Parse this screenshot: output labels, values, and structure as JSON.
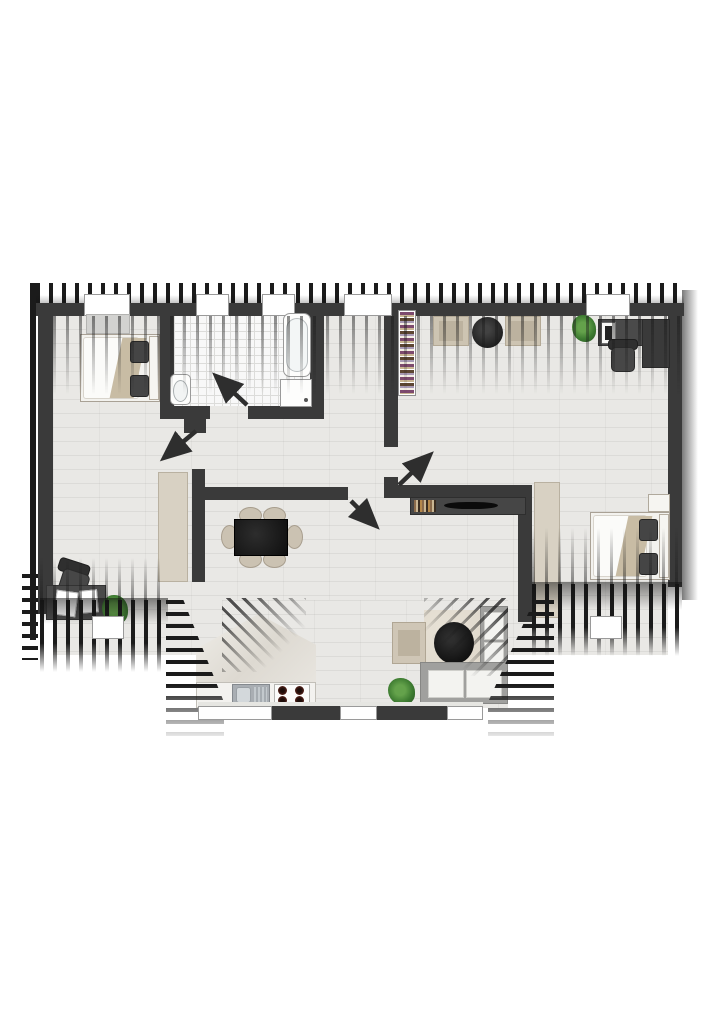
{
  "plan": {
    "canvas": {
      "w": 724,
      "h": 1024,
      "background": "#ffffff"
    },
    "palette": {
      "wall": "#3a3a3a",
      "hatch": "#1b1b1b",
      "floor": "#e9e8e5",
      "tile": "#f8f8f8",
      "tileLine": "#dcdcda",
      "beige": "#cbc2b2",
      "white": "#fbfbf9",
      "pillow": "#454545",
      "blanket": "#c8bca4",
      "green1": "#64a24b",
      "green2": "#2e5c26",
      "sofa": "#a0a09e",
      "cush": "#f3f3f0",
      "rug": "#ddd6c9",
      "steel": "#a9aeb3"
    },
    "shapes": [
      {
        "cls": "floor-wood",
        "name": "floor-main",
        "x": 53,
        "y": 315,
        "w": 615,
        "h": 340
      },
      {
        "cls": "floor-wood",
        "name": "floor-dormer",
        "x": 222,
        "y": 600,
        "w": 286,
        "h": 108
      },
      {
        "cls": "floor-tile",
        "name": "floor-bathroom",
        "x": 174,
        "y": 315,
        "w": 136,
        "h": 91
      },
      {
        "cls": "slope-marble",
        "name": "kitchen-roof-slope",
        "x": 196,
        "y": 614,
        "w": 120,
        "h": 70,
        "clip": "polygon(0 100%, 0 50%, 52% 0, 100% 44%, 100% 100%)"
      },
      {
        "cls": "hatch-v",
        "name": "roof-hatch-top",
        "x": 36,
        "y": 283,
        "w": 648,
        "h": 29
      },
      {
        "cls": "shade-up",
        "name": "roof-shade-top",
        "x": 36,
        "y": 295,
        "w": 648,
        "h": 17
      },
      {
        "cls": "hatch-line",
        "name": "roof-edge-left",
        "x": 30,
        "y": 283,
        "w": 6,
        "h": 357
      },
      {
        "cls": "grad-right",
        "name": "roof-shade-right",
        "x": 682,
        "y": 290,
        "w": 16,
        "h": 310
      },
      {
        "cls": "hatch-h",
        "name": "roof-hatch-left-corner",
        "x": 22,
        "y": 574,
        "w": 16,
        "h": 86
      },
      {
        "cls": "wall",
        "name": "wall-top",
        "x": 36,
        "y": 303,
        "w": 648,
        "h": 13
      },
      {
        "cls": "wall",
        "name": "wall-left",
        "x": 38,
        "y": 312,
        "w": 15,
        "h": 302
      },
      {
        "cls": "wall",
        "name": "wall-right",
        "x": 668,
        "y": 312,
        "w": 14,
        "h": 275
      },
      {
        "cls": "wall",
        "name": "wall-bath-left",
        "x": 160,
        "y": 315,
        "w": 14,
        "h": 104
      },
      {
        "cls": "wall",
        "name": "wall-bath-bottom-left",
        "x": 160,
        "y": 406,
        "w": 50,
        "h": 13
      },
      {
        "cls": "wall",
        "name": "wall-bath-bottom-right",
        "x": 248,
        "y": 406,
        "w": 76,
        "h": 13
      },
      {
        "cls": "wall",
        "name": "wall-bath-right",
        "x": 310,
        "y": 315,
        "w": 14,
        "h": 104
      },
      {
        "cls": "wall",
        "name": "wall-bedroom1-door-jamb",
        "x": 184,
        "y": 406,
        "w": 22,
        "h": 27
      },
      {
        "cls": "wall",
        "name": "wall-lroom-left",
        "x": 384,
        "y": 315,
        "w": 14,
        "h": 132
      },
      {
        "cls": "wall",
        "name": "wall-living-top",
        "x": 192,
        "y": 487,
        "w": 156,
        "h": 13
      },
      {
        "cls": "wall",
        "name": "wall-living-left",
        "x": 192,
        "y": 469,
        "w": 13,
        "h": 113
      },
      {
        "cls": "wall",
        "name": "wall-lroom-bottom",
        "x": 384,
        "y": 485,
        "w": 148,
        "h": 13
      },
      {
        "cls": "wall",
        "name": "wall-lroom-door-jamb",
        "x": 384,
        "y": 477,
        "w": 14,
        "h": 20
      },
      {
        "cls": "wall",
        "name": "wall-bedroom2-left",
        "x": 518,
        "y": 498,
        "w": 14,
        "h": 124
      },
      {
        "cls": "window",
        "name": "window-bedroom1-top",
        "x": 84,
        "y": 294,
        "w": 46,
        "h": 22
      },
      {
        "cls": "window",
        "name": "window-bathroom-1",
        "x": 196,
        "y": 294,
        "w": 33,
        "h": 22
      },
      {
        "cls": "window",
        "name": "window-bathroom-2",
        "x": 262,
        "y": 294,
        "w": 33,
        "h": 22
      },
      {
        "cls": "window",
        "name": "window-hall-top",
        "x": 344,
        "y": 294,
        "w": 48,
        "h": 22
      },
      {
        "cls": "window",
        "name": "window-lroom-top",
        "x": 586,
        "y": 294,
        "w": 44,
        "h": 22
      },
      {
        "cls": "dresser",
        "name": "dresser-bedroom1",
        "x": 86,
        "y": 314,
        "w": 44,
        "h": 20
      },
      {
        "cls": "bedframe",
        "name": "bed1-frame",
        "x": 80,
        "y": 334,
        "w": 80,
        "h": 68
      },
      {
        "cls": "duvet",
        "name": "bed1-duvet",
        "x": 83,
        "y": 337,
        "w": 56,
        "h": 62
      },
      {
        "cls": "blanket",
        "name": "bed1-blanket",
        "x": 116,
        "y": 338,
        "w": 24,
        "h": 60,
        "skew": -12
      },
      {
        "cls": "headboard",
        "name": "bed1-headboard",
        "x": 149,
        "y": 336,
        "w": 10,
        "h": 64
      },
      {
        "cls": "pillow",
        "name": "bed1-pillow-a",
        "x": 130,
        "y": 341,
        "w": 19,
        "h": 22
      },
      {
        "cls": "pillow",
        "name": "bed1-pillow-b",
        "x": 130,
        "y": 375,
        "w": 19,
        "h": 22
      },
      {
        "cls": "wardrobe",
        "name": "wardrobe-bedroom1",
        "x": 158,
        "y": 472,
        "w": 30,
        "h": 110
      },
      {
        "cls": "chair-office",
        "name": "desk1-chair-back",
        "x": 58,
        "y": 561,
        "w": 32,
        "h": 14,
        "rot": 18
      },
      {
        "cls": "chair-office-seat",
        "name": "desk1-chair-seat",
        "x": 60,
        "y": 571,
        "w": 28,
        "h": 24,
        "rot": 18
      },
      {
        "cls": "desk-dark",
        "name": "desk1",
        "x": 46,
        "y": 585,
        "w": 60,
        "h": 35
      },
      {
        "cls": "paper",
        "name": "desk1-paper-a",
        "x": 55,
        "y": 591,
        "w": 22,
        "h": 25,
        "rot": 8
      },
      {
        "cls": "paper",
        "name": "desk1-paper-b",
        "x": 80,
        "y": 590,
        "w": 18,
        "h": 23,
        "rot": -5
      },
      {
        "cls": "plant",
        "name": "plant-bedroom1",
        "x": 102,
        "y": 595,
        "w": 26,
        "h": 29
      },
      {
        "cls": "toilet-body",
        "name": "toilet",
        "x": 170,
        "y": 374,
        "w": 21,
        "h": 31
      },
      {
        "cls": "toilet-seat",
        "name": "toilet-seat",
        "x": 173,
        "y": 380,
        "w": 15,
        "h": 22
      },
      {
        "cls": "tub",
        "name": "bathtub",
        "x": 283,
        "y": 313,
        "w": 28,
        "h": 64
      },
      {
        "cls": "tub-inner",
        "name": "bathtub-basin",
        "x": 286,
        "y": 318,
        "w": 22,
        "h": 54
      },
      {
        "cls": "shower",
        "name": "shower-tray",
        "x": 280,
        "y": 379,
        "w": 32,
        "h": 28
      },
      {
        "cls": "dot",
        "name": "shower-drain",
        "x": 304,
        "y": 398,
        "w": 4,
        "h": 4
      },
      {
        "cls": "chair-round",
        "name": "dining-chair-1",
        "x": 239,
        "y": 507,
        "w": 23,
        "h": 17
      },
      {
        "cls": "chair-round",
        "name": "dining-chair-2",
        "x": 263,
        "y": 507,
        "w": 23,
        "h": 17
      },
      {
        "cls": "chair-round",
        "name": "dining-chair-3",
        "x": 239,
        "y": 551,
        "w": 23,
        "h": 17
      },
      {
        "cls": "chair-round",
        "name": "dining-chair-4",
        "x": 263,
        "y": 551,
        "w": 23,
        "h": 17
      },
      {
        "cls": "chair-round",
        "name": "dining-chair-5",
        "x": 221,
        "y": 525,
        "w": 17,
        "h": 24
      },
      {
        "cls": "chair-round",
        "name": "dining-chair-6",
        "x": 286,
        "y": 525,
        "w": 17,
        "h": 24
      },
      {
        "cls": "table-black",
        "name": "dining-table",
        "x": 234,
        "y": 519,
        "w": 54,
        "h": 37
      },
      {
        "cls": "sideboard",
        "name": "tv-sideboard",
        "x": 410,
        "y": 497,
        "w": 116,
        "h": 18
      },
      {
        "cls": "books-h",
        "name": "sideboard-books",
        "x": 414,
        "y": 500,
        "w": 22,
        "h": 12
      },
      {
        "cls": "tv",
        "name": "tv",
        "x": 444,
        "y": 502,
        "w": 54,
        "h": 7
      },
      {
        "cls": "bookshelf",
        "name": "bookshelf",
        "x": 398,
        "y": 310,
        "w": 18,
        "h": 86
      },
      {
        "cls": "books-v",
        "name": "bookshelf-books",
        "x": 400,
        "y": 312,
        "w": 14,
        "h": 82
      },
      {
        "cls": "cushion",
        "name": "floor-cushion-a",
        "x": 433,
        "y": 316,
        "w": 36,
        "h": 30
      },
      {
        "cls": "cushion-in",
        "name": "floor-cushion-a-inner",
        "x": 439,
        "y": 321,
        "w": 24,
        "h": 20
      },
      {
        "cls": "pouf",
        "name": "pouf",
        "x": 472,
        "y": 317,
        "w": 31,
        "h": 31
      },
      {
        "cls": "cushion",
        "name": "floor-cushion-b",
        "x": 505,
        "y": 316,
        "w": 36,
        "h": 30
      },
      {
        "cls": "cushion-in",
        "name": "floor-cushion-b-inner",
        "x": 511,
        "y": 321,
        "w": 24,
        "h": 20
      },
      {
        "cls": "plant",
        "name": "plant-lroom",
        "x": 572,
        "y": 315,
        "w": 24,
        "h": 27
      },
      {
        "cls": "desk-dark",
        "name": "desk2-top",
        "x": 598,
        "y": 319,
        "w": 72,
        "h": 27
      },
      {
        "cls": "desk-darker",
        "name": "desk2-side",
        "x": 642,
        "y": 319,
        "w": 28,
        "h": 49
      },
      {
        "cls": "monitor",
        "name": "monitor",
        "x": 601,
        "y": 322,
        "w": 15,
        "h": 22
      },
      {
        "cls": "screen",
        "name": "monitor-screen",
        "x": 605,
        "y": 326,
        "w": 7,
        "h": 14
      },
      {
        "cls": "chair-office",
        "name": "desk2-chair-back",
        "x": 608,
        "y": 339,
        "w": 30,
        "h": 11
      },
      {
        "cls": "chair-office-seat",
        "name": "desk2-chair-seat",
        "x": 611,
        "y": 347,
        "w": 24,
        "h": 25
      },
      {
        "cls": "wardrobe",
        "name": "wardrobe-bedroom2",
        "x": 534,
        "y": 482,
        "w": 26,
        "h": 136
      },
      {
        "cls": "nightstand",
        "name": "nightstand",
        "x": 648,
        "y": 494,
        "w": 22,
        "h": 18
      },
      {
        "cls": "bedframe",
        "name": "bed2-frame",
        "x": 590,
        "y": 512,
        "w": 80,
        "h": 68
      },
      {
        "cls": "duvet",
        "name": "bed2-duvet",
        "x": 593,
        "y": 515,
        "w": 54,
        "h": 62
      },
      {
        "cls": "blanket",
        "name": "bed2-blanket",
        "x": 622,
        "y": 516,
        "w": 24,
        "h": 60,
        "skew": -12
      },
      {
        "cls": "headboard",
        "name": "bed2-headboard",
        "x": 659,
        "y": 514,
        "w": 10,
        "h": 64
      },
      {
        "cls": "pillow",
        "name": "bed2-pillow-a",
        "x": 639,
        "y": 519,
        "w": 19,
        "h": 22
      },
      {
        "cls": "pillow",
        "name": "bed2-pillow-b",
        "x": 639,
        "y": 553,
        "w": 19,
        "h": 22
      },
      {
        "cls": "counter",
        "name": "kitchen-counter",
        "x": 196,
        "y": 682,
        "w": 120,
        "h": 26
      },
      {
        "cls": "sink-outer",
        "name": "kitchen-sink",
        "x": 232,
        "y": 684,
        "w": 38,
        "h": 22
      },
      {
        "cls": "sink-bowl",
        "name": "sink-bowl",
        "x": 236,
        "y": 687,
        "w": 15,
        "h": 16
      },
      {
        "cls": "sink-drain",
        "name": "sink-drainboard",
        "x": 254,
        "y": 687,
        "w": 13,
        "h": 16
      },
      {
        "cls": "hob",
        "name": "hob",
        "x": 274,
        "y": 684,
        "w": 36,
        "h": 22
      },
      {
        "cls": "burner",
        "name": "hob-burner-1",
        "x": 278,
        "y": 686,
        "w": 9,
        "h": 9
      },
      {
        "cls": "burner",
        "name": "hob-burner-2",
        "x": 295,
        "y": 686,
        "w": 9,
        "h": 9
      },
      {
        "cls": "burner",
        "name": "hob-burner-3",
        "x": 278,
        "y": 696,
        "w": 9,
        "h": 9
      },
      {
        "cls": "burner",
        "name": "hob-burner-4",
        "x": 295,
        "y": 696,
        "w": 9,
        "h": 9
      },
      {
        "cls": "rug",
        "name": "lounge-rug",
        "x": 424,
        "y": 610,
        "w": 62,
        "h": 64
      },
      {
        "cls": "armchair",
        "name": "armchair",
        "x": 392,
        "y": 622,
        "w": 34,
        "h": 42
      },
      {
        "cls": "cushion-in",
        "name": "armchair-cushion",
        "x": 398,
        "y": 630,
        "w": 22,
        "h": 26
      },
      {
        "cls": "ctable",
        "name": "coffee-table",
        "x": 434,
        "y": 622,
        "w": 40,
        "h": 42
      },
      {
        "cls": "sofa-frame",
        "name": "sofa-right-arm",
        "x": 480,
        "y": 606,
        "w": 28,
        "h": 98
      },
      {
        "cls": "sofa-cushion",
        "name": "sofa-cushion-1",
        "x": 484,
        "y": 612,
        "w": 20,
        "h": 28
      },
      {
        "cls": "sofa-cushion",
        "name": "sofa-cushion-2",
        "x": 484,
        "y": 642,
        "w": 20,
        "h": 28
      },
      {
        "cls": "sofa-frame",
        "name": "sofa-base",
        "x": 420,
        "y": 662,
        "w": 88,
        "h": 42
      },
      {
        "cls": "sofa-cushion",
        "name": "sofa-cushion-3",
        "x": 428,
        "y": 670,
        "w": 36,
        "h": 28
      },
      {
        "cls": "sofa-cushion",
        "name": "sofa-cushion-4",
        "x": 466,
        "y": 670,
        "w": 36,
        "h": 28
      },
      {
        "cls": "plant",
        "name": "plant-lounge",
        "x": 388,
        "y": 678,
        "w": 27,
        "h": 27
      },
      {
        "cls": "stripe-fade-down",
        "name": "roof-slope-shadow-top",
        "x": 53,
        "y": 316,
        "w": 630,
        "h": 78
      },
      {
        "cls": "stripe-fade-up",
        "name": "roof-slope-shadow-bottom-left",
        "x": 40,
        "y": 558,
        "w": 128,
        "h": 44
      },
      {
        "cls": "stripe-fade-up",
        "name": "roof-slope-shadow-bottom-right",
        "x": 532,
        "y": 528,
        "w": 150,
        "h": 58
      },
      {
        "cls": "hatch-v fadeB",
        "name": "roof-hatch-bottom-left",
        "x": 40,
        "y": 600,
        "w": 128,
        "h": 72
      },
      {
        "cls": "shade-down",
        "name": "roof-shade-bottom-left",
        "x": 40,
        "y": 598,
        "w": 128,
        "h": 26
      },
      {
        "cls": "hatch-v fadeB",
        "name": "roof-hatch-bottom-right",
        "x": 532,
        "y": 584,
        "w": 150,
        "h": 72
      },
      {
        "cls": "shade-down",
        "name": "roof-shade-bottom-right",
        "x": 532,
        "y": 582,
        "w": 150,
        "h": 28
      },
      {
        "cls": "hatch-h fadeB",
        "name": "dormer-flank-left",
        "x": 166,
        "y": 600,
        "w": 58,
        "h": 142,
        "clip": "polygon(0 0, 30% 0, 100% 72%, 100% 100%, 0 100%)"
      },
      {
        "cls": "hatch-h fadeB",
        "name": "dormer-flank-right",
        "x": 488,
        "y": 600,
        "w": 66,
        "h": 142,
        "clip": "polygon(70% 0, 100% 0, 100% 100%, 0 100%, 0 72%)"
      },
      {
        "cls": "hatch-d2",
        "name": "dormer-slope-hatch-left",
        "x": 222,
        "y": 598,
        "w": 84,
        "h": 74
      },
      {
        "cls": "hatch-d1",
        "name": "dormer-slope-hatch-right",
        "x": 424,
        "y": 598,
        "w": 84,
        "h": 78
      },
      {
        "cls": "sill",
        "name": "dormer-sill",
        "x": 198,
        "y": 702,
        "w": 285,
        "h": 5
      },
      {
        "cls": "wall",
        "name": "dormer-wall-1",
        "x": 272,
        "y": 706,
        "w": 68,
        "h": 14
      },
      {
        "cls": "wall",
        "name": "dormer-wall-2",
        "x": 377,
        "y": 706,
        "w": 70,
        "h": 14
      },
      {
        "cls": "window",
        "name": "dormer-window-left",
        "x": 198,
        "y": 706,
        "w": 74,
        "h": 14
      },
      {
        "cls": "window",
        "name": "dormer-window-mid",
        "x": 340,
        "y": 706,
        "w": 37,
        "h": 14
      },
      {
        "cls": "window",
        "name": "dormer-window-right",
        "x": 447,
        "y": 706,
        "w": 36,
        "h": 14
      },
      {
        "cls": "window",
        "name": "window-bedroom1-bottom",
        "x": 92,
        "y": 616,
        "w": 32,
        "h": 23
      },
      {
        "cls": "window",
        "name": "window-bedroom2-bottom",
        "x": 590,
        "y": 616,
        "w": 32,
        "h": 23
      }
    ],
    "doors": [
      {
        "name": "door-swing-bathroom",
        "x1": 247,
        "y1": 405,
        "x2": 217,
        "y2": 377
      },
      {
        "name": "door-swing-bedroom1",
        "x1": 196,
        "y1": 431,
        "x2": 165,
        "y2": 457
      },
      {
        "name": "door-swing-living",
        "x1": 351,
        "y1": 501,
        "x2": 375,
        "y2": 525
      },
      {
        "name": "door-swing-lroom",
        "x1": 399,
        "y1": 485,
        "x2": 429,
        "y2": 456
      }
    ],
    "door_color": "#2e2e2e"
  }
}
